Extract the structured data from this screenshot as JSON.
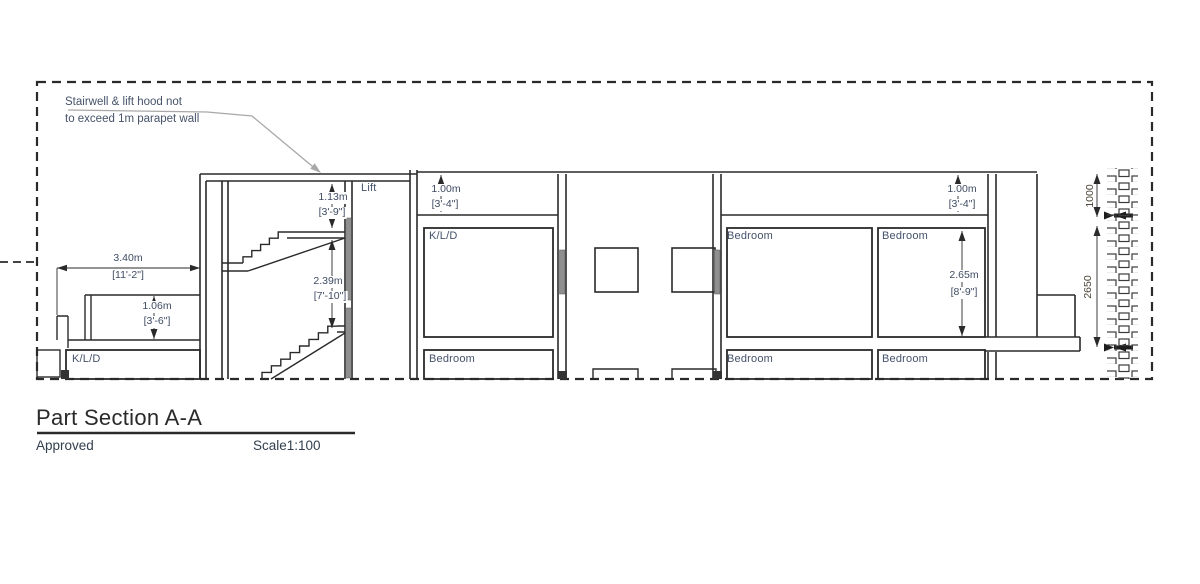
{
  "drawing": {
    "annotation": {
      "line1": "Stairwell & lift hood not",
      "line2": "to exceed 1m parapet wall"
    },
    "labels": {
      "lift": "Lift",
      "kld": "K/L/D",
      "bedroom": "Bedroom"
    },
    "dimensions": {
      "w340": {
        "metric": "3.40m",
        "imperial": "[11'-2\"]"
      },
      "h106": {
        "metric": "1.06m",
        "imperial": "[3'-6\"]"
      },
      "h113": {
        "metric": "1.13m",
        "imperial": "[3'-9\"]"
      },
      "h239": {
        "metric": "2.39m",
        "imperial": "[7'-10\"]"
      },
      "h100L": {
        "metric": "1.00m",
        "imperial": "[3'-4\"]"
      },
      "h100R": {
        "metric": "1.00m",
        "imperial": "[3'-4\"]"
      },
      "h265": {
        "metric": "2.65m",
        "imperial": "[8'-9\"]"
      },
      "mm1000": "1000",
      "mm2650": "2650"
    },
    "title_block": {
      "title": "Part Section A-A",
      "status": "Approved",
      "scale": "Scale1:100"
    },
    "colors": {
      "line": "#2a2a2a",
      "label_text": "#45526b",
      "leader": "#a8a8a8",
      "opening_fill": "#8f8f8f"
    }
  }
}
